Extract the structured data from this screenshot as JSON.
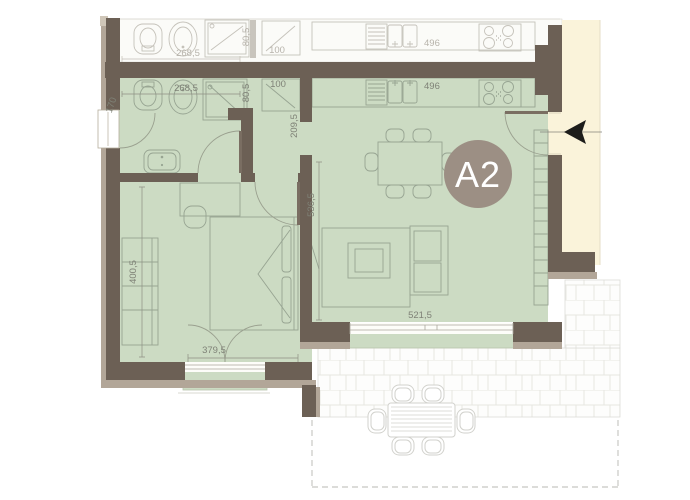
{
  "unit_badge": {
    "label": "A2"
  },
  "dims": {
    "bathroom_width": "268,5",
    "shower_width": "80,5",
    "closet_width": "100",
    "kitchen_length": "496",
    "entry_window": "170",
    "hall_length": "209,5",
    "living_length": "536,5",
    "bedroom_length": "400,5",
    "bedroom_width": "379,5",
    "living_window_width": "521,5"
  },
  "neighbor_dims": {
    "bathroom_width": "268,5",
    "shower_width": "80,5",
    "closet_width": "100",
    "kitchen_length": "496"
  },
  "colors": {
    "unit_floor": "#ccdbc3",
    "wall_dark": "#6c6055",
    "wall_band": "#b2a698",
    "corridor": "#faf3da",
    "neighbor_floor": "#fbfbf8",
    "badge": "#9c8f84",
    "dim_text": "#7f8277",
    "neighbor_dim_text": "#b7b3ab",
    "tile_line": "#e6e6e1",
    "arrow": "#1d1d1b"
  }
}
